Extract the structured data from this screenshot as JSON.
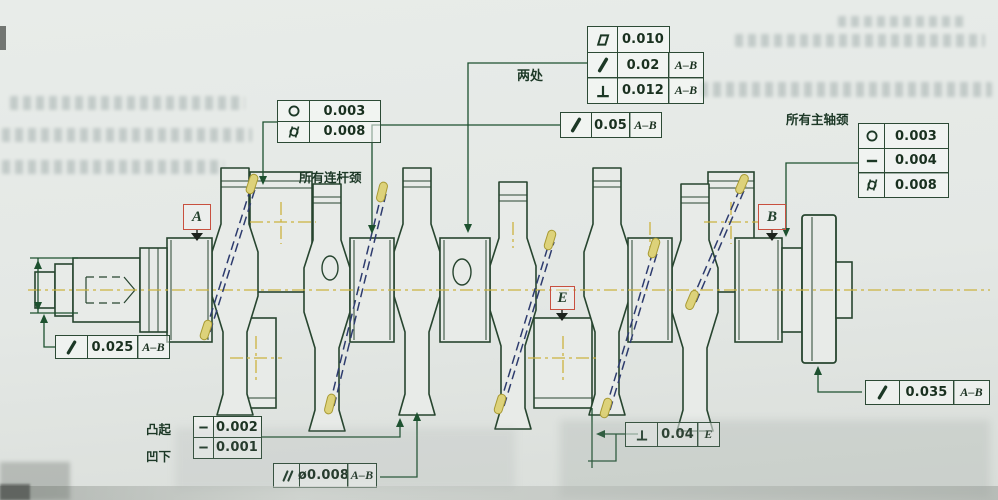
{
  "colors": {
    "paper": "#e6eae7",
    "drawing_line": "#27452f",
    "centerline_yellow": "#ccb23f",
    "oil_passage_blue": "#2e3c6e",
    "oil_highlight": "#ddd27a",
    "datum_box_red": "#c8503f",
    "leader_green": "#1d512f",
    "frame_border_green": "#2c4a35"
  },
  "datums": {
    "a": "A",
    "b": "B",
    "e": "E"
  },
  "labels": {
    "two_places": "两处",
    "all_rod_journals": "所有连杆颈",
    "all_main_journals": "所有主轴颈",
    "raised": "凸起",
    "recessed": "凹下"
  },
  "frames": {
    "top_stack": {
      "rows": [
        {
          "symbol": "flatness",
          "value": "0.010",
          "datum": ""
        },
        {
          "symbol": "circular-runout",
          "value": "0.02",
          "datum": "A–B"
        },
        {
          "symbol": "perpendicularity",
          "value": "0.012",
          "datum": "A–B"
        }
      ]
    },
    "runout_005": {
      "symbol": "circular-runout",
      "value": "0.05",
      "datum": "A–B"
    },
    "rod_journals": {
      "rows": [
        {
          "symbol": "circularity",
          "value": "0.003"
        },
        {
          "symbol": "cylindricity",
          "value": "0.008"
        }
      ]
    },
    "main_journals": {
      "rows": [
        {
          "symbol": "circularity",
          "value": "0.003"
        },
        {
          "symbol": "straightness",
          "value": "0.004"
        },
        {
          "symbol": "cylindricity",
          "value": "0.008"
        }
      ]
    },
    "runout_0025": {
      "symbol": "circular-runout",
      "value": "0.025",
      "datum": "A–B"
    },
    "raised": {
      "symbol": "straightness",
      "value": "0.002"
    },
    "recessed": {
      "symbol": "straightness",
      "value": "0.001"
    },
    "parallelism": {
      "symbol": "parallelism",
      "value": "ø0.008",
      "datum": "A–B"
    },
    "perp_e": {
      "symbol": "perpendicularity",
      "value": "0.04",
      "datum": "E"
    },
    "runout_0035": {
      "symbol": "circular-runout",
      "value": "0.035",
      "datum": "A–B"
    }
  },
  "icons": {
    "flatness-icon": "▱",
    "circular-runout-icon": "↗",
    "perpendicularity-icon": "⊥",
    "circularity-icon": "○",
    "cylindricity-icon": "⌭",
    "straightness-icon": "—",
    "parallelism-icon": "∥",
    "datum-triangle-icon": "▼"
  }
}
